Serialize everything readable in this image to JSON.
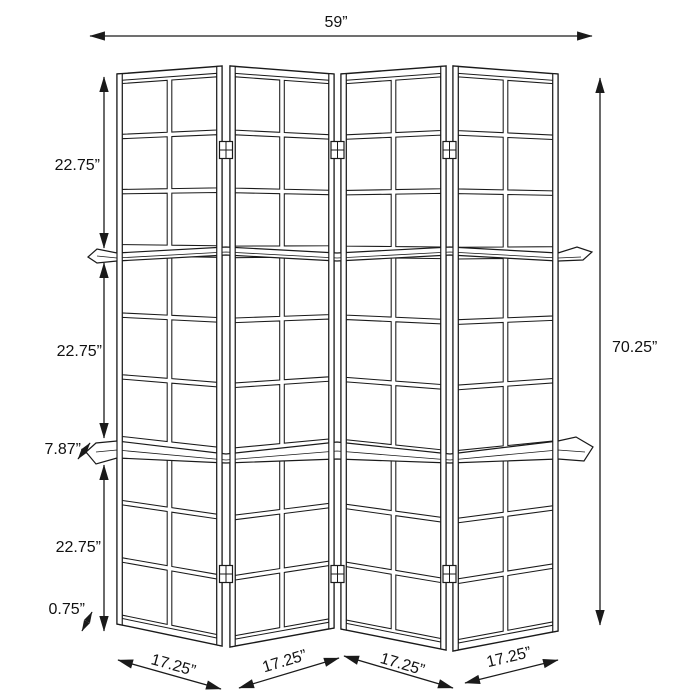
{
  "diagram": {
    "subject": "four-panel-folding-screen-with-shelves",
    "dimensions": {
      "overall_width": "59”",
      "overall_height": "70.25”",
      "section_heights": [
        "22.75”",
        "22.75”",
        "22.75”"
      ],
      "shelf_depth": "7.87”",
      "base_height": "0.75”",
      "panel_widths": [
        "17.25”",
        "17.25”",
        "17.25”",
        "17.25”"
      ]
    },
    "colors": {
      "line": "#1a1a1a",
      "background": "#ffffff"
    }
  }
}
